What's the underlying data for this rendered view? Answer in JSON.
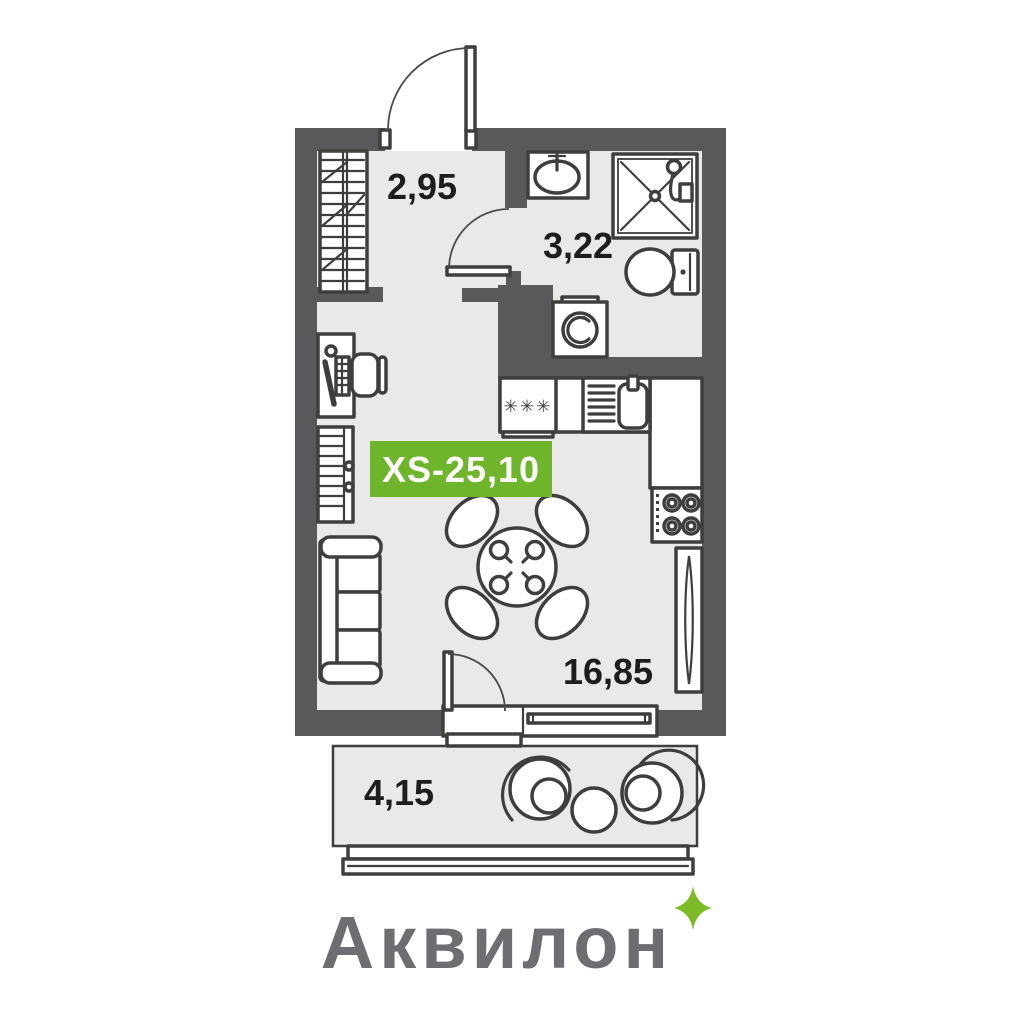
{
  "plan": {
    "badge": {
      "label": "XS-25,10"
    },
    "rooms": {
      "hallway": {
        "area": "2,95"
      },
      "bathroom": {
        "area": "3,22"
      },
      "living": {
        "area": "16,85"
      },
      "balcony": {
        "area": "4,15"
      }
    },
    "kitchen": {
      "stars": "✳✳✳"
    },
    "colors": {
      "background": "#ffffff",
      "wall": "#58595b",
      "floor": "#e9e9e9",
      "line": "#3e3e3d",
      "badge_bg": "#6fb52c",
      "badge_text": "#ffffff",
      "label": "#1d1d1b",
      "logo": "#6d6e71",
      "sparkle": "#7cba28"
    },
    "icons": [
      "wardrobe-icon",
      "entrance-door-icon",
      "interior-door-icon",
      "desk-icon",
      "desk-chair-icon",
      "shelving-icon",
      "sofa-icon",
      "dining-table-icon",
      "dining-chair-icon",
      "bath-sink-icon",
      "shower-icon",
      "toilet-icon",
      "washing-machine-icon",
      "kitchen-stars-icon",
      "kitchen-sink-icon",
      "hob-icon",
      "tall-cabinet-icon",
      "balcony-door-icon",
      "window-icon",
      "armchair-icon",
      "coffee-table-icon",
      "sparkle-icon"
    ]
  },
  "brand": {
    "name": "Аквилон"
  }
}
